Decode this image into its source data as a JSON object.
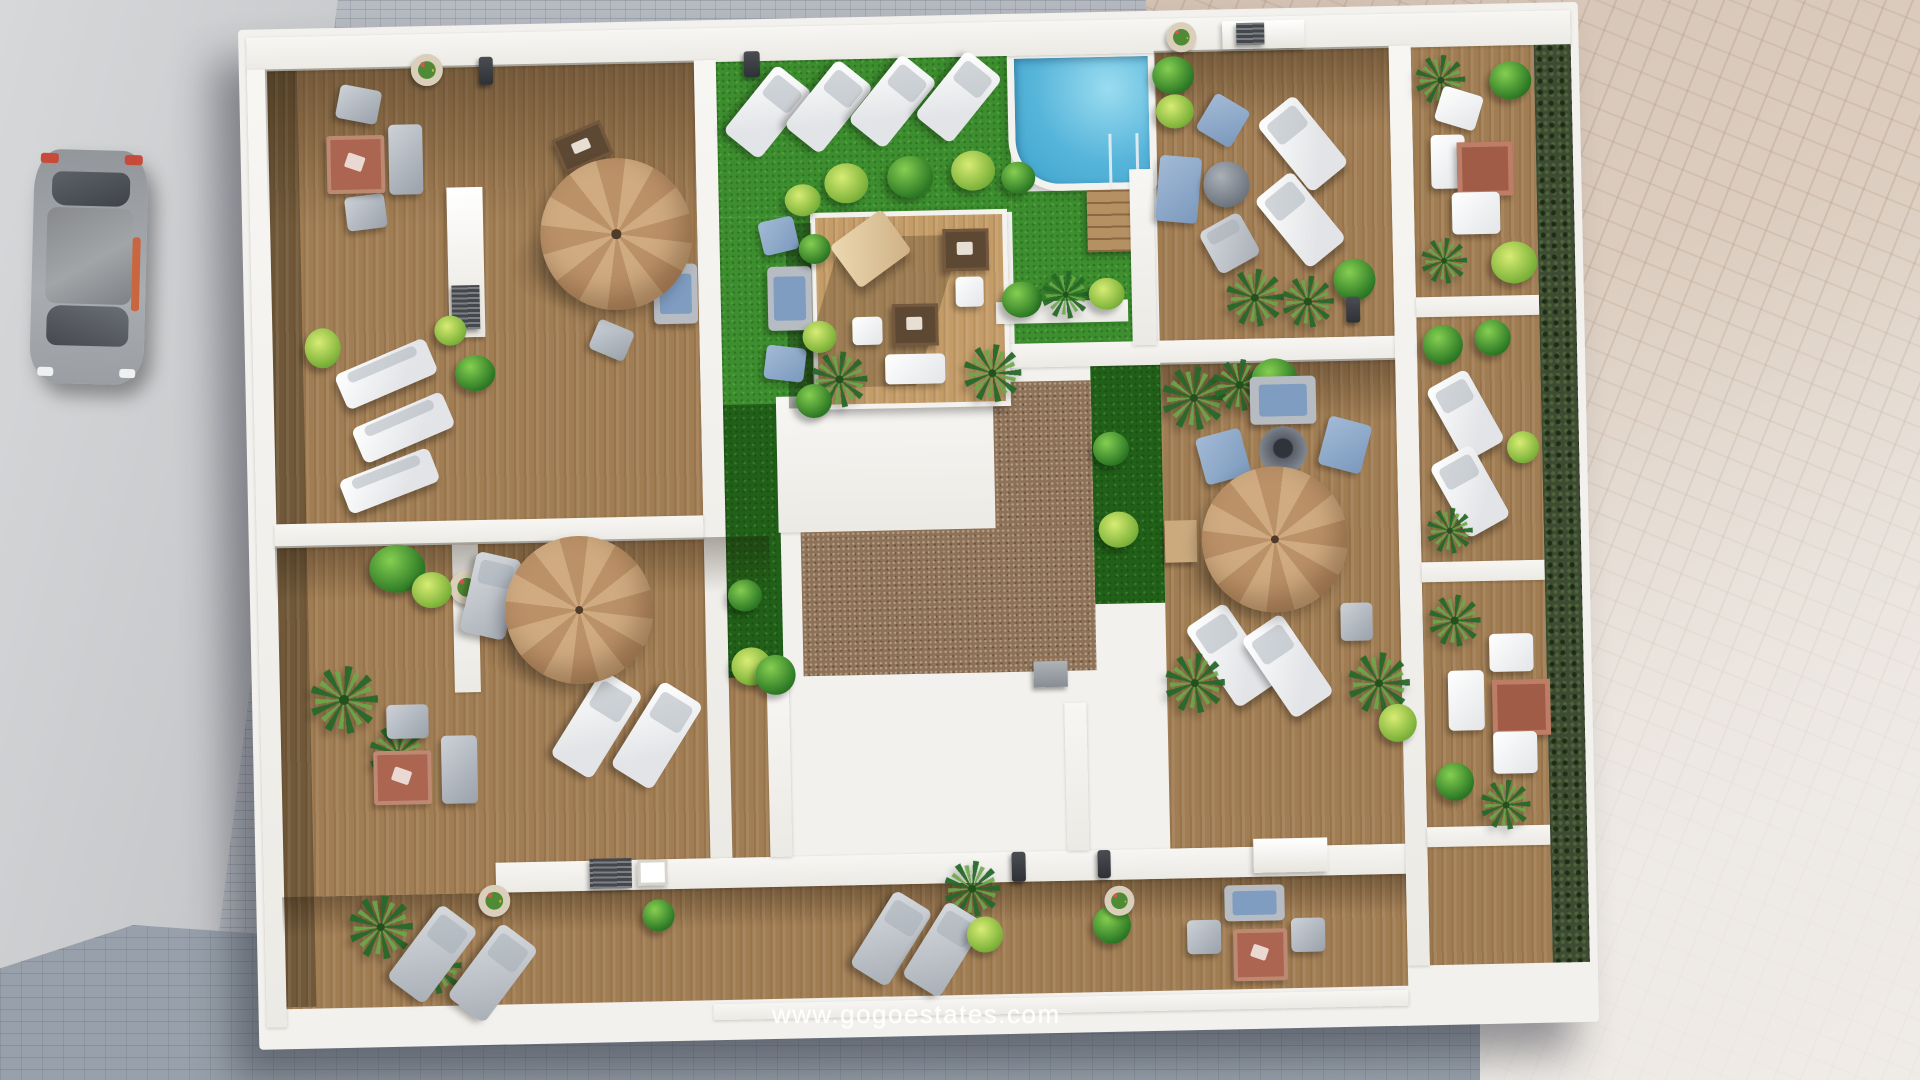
{
  "watermark": {
    "text": "www.gogoestates.com"
  },
  "scene": {
    "type": "aerial-3d-architectural-render",
    "description": "Top-down 3D render of an apartment building rooftop: eight private wooden terraces around a central artificial-lawn courtyard with swimming pool, pergola lounge deck and service-core roofs; streets and sidewalks around the block",
    "colors": {
      "artificial_grass": "#3c8e2e",
      "grass_shadow": "#216018",
      "terrace_wood": "#a17d53",
      "pergola_deck_wood": "#c49c68",
      "pool_water": "#57b5da",
      "pool_rim": "#f3f2ee",
      "gravel_roof": "#8e7257",
      "core_roof_white": "#f2f1ed",
      "divider_walls": "#f4f3f0",
      "parasol_canopy": "#c6a077",
      "cushion_blue": "#7f9dc1",
      "rug_terracotta": "#ab6550",
      "street_cobbles": "#b6bac1",
      "bottom_street_cobbles": "#98a1ab",
      "sidewalk_pink": "#d5c3b3",
      "road_asphalt": "#cdced1",
      "hedge_dark": "#3e4a33"
    },
    "objects": [
      "swimming pool with ladder and wooden steps",
      "central pergola lounge deck with daybed, tables and seat cushions",
      "3 beige cantilever parasols",
      "30+ white and grey sun loungers",
      "outdoor sofas and armchairs with blue cushions",
      "round coffee tables and fire-pit tables",
      "terracotta rugs",
      "palms, box bushes and flower planters",
      "artificial lawn courtyard strips",
      "white stairwell core roof and brown gravel roof",
      "rooftop kitchenettes with grill and sink",
      "parked car on street",
      "scooter on sidewalk",
      "cobblestone street and pink paved promenade"
    ]
  }
}
